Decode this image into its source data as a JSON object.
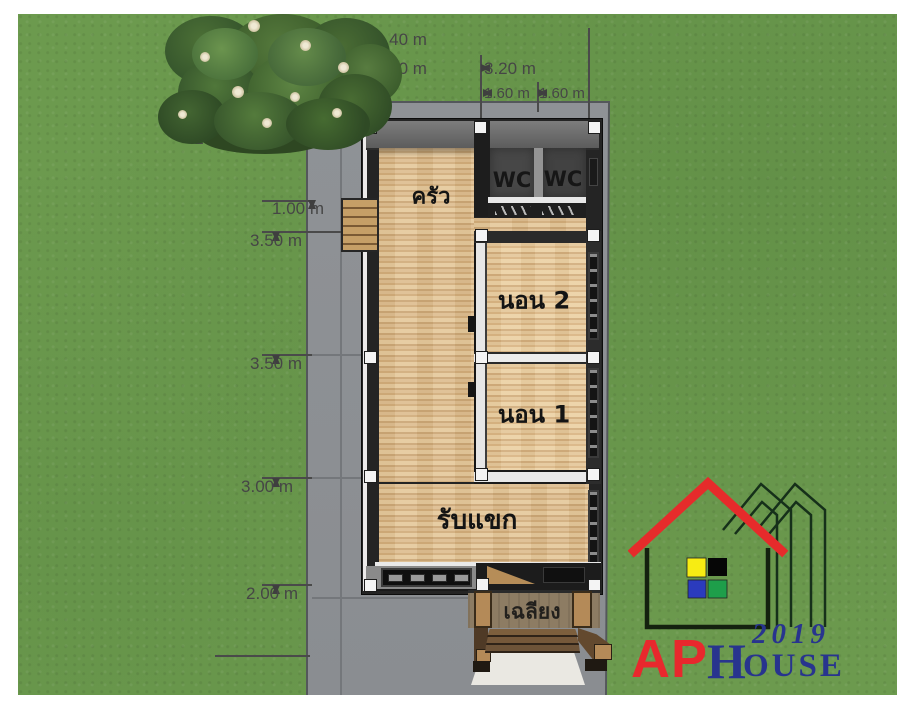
{
  "plan": {
    "rooms": {
      "kitchen": "ครัว",
      "wc_left": "WC",
      "wc_right": "WC",
      "bedroom2": "นอน 2",
      "bedroom1": "นอน 1",
      "living": "รับแขก",
      "porch": "เฉลียง"
    },
    "dims": {
      "top_total": "6.40 m",
      "top_half_left": "3.20 m",
      "top_half_right": "3.20 m",
      "top_quarter_left": "1.60 m",
      "top_quarter_right": "1.60 m",
      "left_back_setback": "2.00 m",
      "left_service_zone": "3.00 m",
      "left_corridor": "1.00 m",
      "left_bed2": "3.50 m",
      "left_total": "15.00 m",
      "left_bed1": "3.50 m",
      "left_living": "3.00 m",
      "left_porch": "2.00 m"
    }
  },
  "logo": {
    "brand_ap": "AP",
    "brand_house_initial": "H",
    "brand_house_rest": "OUSE",
    "year": "2019"
  },
  "colors": {
    "grass": "#6c9a4e",
    "concrete_pad": "#8d9094",
    "wood_floor": "#d9b98c",
    "wall_dark": "#1c1c1c",
    "roof_red": "#e62b2b",
    "logo_red": "#e8282d",
    "logo_navy": "#28348e",
    "logo_yellow": "#f7ec13",
    "logo_blue": "#2b3bbd",
    "logo_green": "#1e9e4a"
  }
}
